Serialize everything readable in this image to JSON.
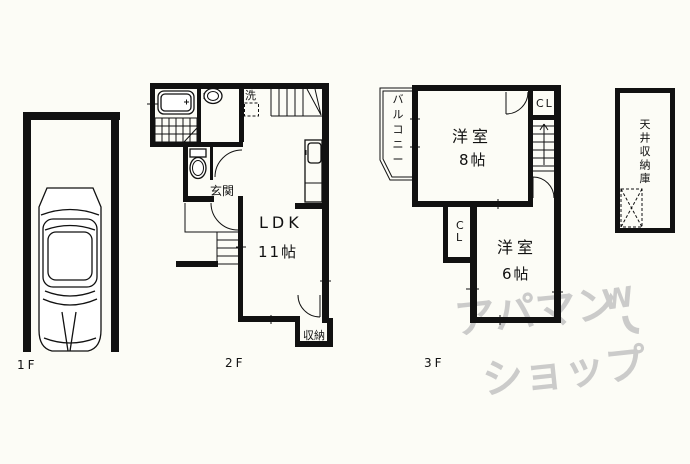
{
  "floorplan": {
    "floor1": {
      "label": "1F"
    },
    "floor2": {
      "label": "2F",
      "ldk": {
        "name": "LDK",
        "size": "11帖"
      },
      "entrance_label": "玄関",
      "laundry_label": "洗",
      "closet_label": "収納"
    },
    "floor3": {
      "label": "3F",
      "room8": {
        "name": "洋室",
        "size": "8帖"
      },
      "room6": {
        "name": "洋室",
        "size": "6帖"
      },
      "closet_top": "CL",
      "closet_side": "CL",
      "balcony_label": "バルコニー",
      "attic_label": "天井収納庫"
    },
    "watermark": {
      "line1": "アパマン",
      "line2": "ショップ",
      "logo": "W"
    },
    "colors": {
      "line": "#111111",
      "background": "#fcfcf6",
      "watermark": "#c3c3c3"
    }
  }
}
